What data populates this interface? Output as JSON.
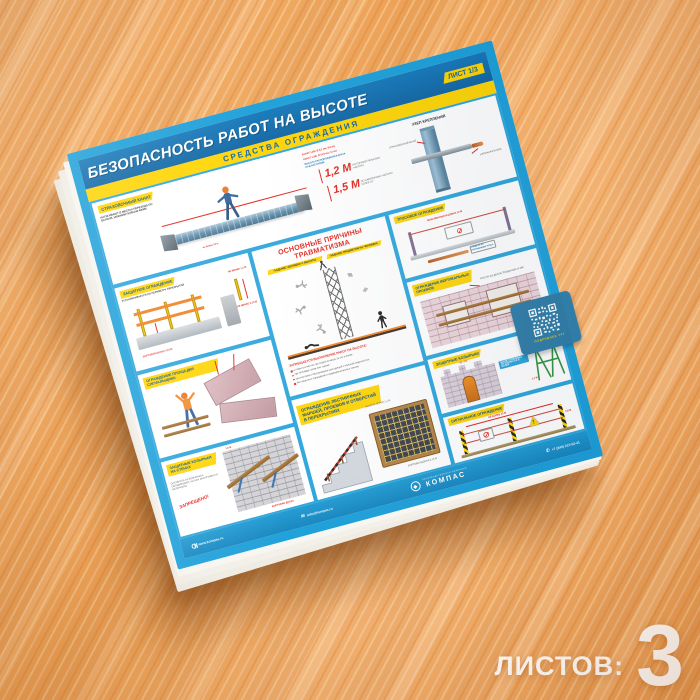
{
  "caption": {
    "sheets_label": "ЛИСТОВ:",
    "sheets_value": "3"
  },
  "colors": {
    "accent_blue": "#1b9fd9",
    "header_blue": "#0d64a3",
    "yellow": "#ffd400",
    "red": "#e2231a",
    "wood": "#f2ad66"
  },
  "poster": {
    "header": {
      "title": "БЕЗОПАСНОСТЬ РАБОТ НА ВЫСОТЕ",
      "sheet_badge": "ЛИСТ 1/3",
      "subtitle": "СРЕДСТВА ОГРАЖДЕНИЯ"
    },
    "sections": {
      "safety_rope": {
        "label": "СТРАХОВОЧНЫЙ КАНАТ",
        "note": "НАТЯГИВАЮТ В МЕСТАХ ПЕРЕХОДА ПО БАЛКАМ, НИЖНИМ ПОЯСАМ ФЕРМ",
        "dim_note": "не более 12 м",
        "spec1": "КАНАТ 1,2Б: Ø 9,1 мм; 9,6 мм",
        "spec2": "КАНАТ 1,2В: Ø 10,5 мм; 11 мм",
        "spec_caption": "ВЫСОТА РАСПОЛОЖЕНИЯ КАНАТА НАД НАСТИЛОМ",
        "h1": "1,2 М",
        "h1_caption": "ПО ГОРИЗОНТАЛЬНОМУ НАСТИЛУ",
        "h2": "1,5 М",
        "h2_caption": "ПО НАКЛОННОМУ НАСТИЛУ БОЛЕЕ 20°"
      },
      "anchor": {
        "label": "УЗЕЛ КРЕПЛЕНИЯ",
        "note1": "СТРАХОВОЧНЫЙ КАНАТ",
        "note2": "НАТЯЖНАЯ МУФТА"
      },
      "guard": {
        "label": "ЗАЩИТНОЕ ОГРАЖДЕНИЕ",
        "note": "УСТАНАВЛИВАЕТСЯ ПО ПЕРИМЕТРУ ПЕРЕКРЫТИЙ",
        "dim1": "НЕ МЕНЕЕ 1,1 М",
        "dim2": "НЕ МЕНЕЕ 0,15 М",
        "caption": "БОРТОВАЯ ДОСКА 0,15 М"
      },
      "causes": {
        "title1": "ОСНОВНЫЕ ПРИЧИНЫ",
        "title2": "ТРАВМАТИЗМА",
        "tag1": "ПАДЕНИЕ ЧЕЛОВЕКА С ВЫСОТЫ",
        "tag2": "ПАДЕНИЕ ПРЕДМЕТОВ НА ЧЕЛОВЕКА",
        "ban_title": "ЗАПРЕЩАЕТСЯ ВЫПОЛНЕНИЕ РАБОТ НА ВЫСОТЕ:",
        "ban_items": [
          "в открытых местах при скорости ветра 15 м/с и более",
          "при гололёде, грозе или тумане",
          "при монтаже и обслуживании конструкций с большой парусностью",
          "без защитных ограждений и предохранительных поясов"
        ]
      },
      "cable": {
        "label": "ТРОСОВОЕ ОГРАЖДЕНИЕ",
        "dim": "МАКСИМАЛЬНАЯ ДЛИНА 12 М",
        "note": "СЛЕДИТЬ ЗА НАТЯЖЕНИЕМ ТРОСА"
      },
      "openings": {
        "label": "ОГРАЖДЕНИЕ ВЕРТИКАЛЬНЫХ ПРОЕМОВ",
        "note": "РИГЕЛИ ИЗ ДОСОК ТОЛЩИНОЙ 40 ММ"
      },
      "platform": {
        "label": "ОГРАЖДЕНИЕ ПЛОЩАДКИ СИГНАЛЬЩИКА"
      },
      "visors": {
        "label": "ЗАЩИТНЫЕ КОЗЫРЬКИ",
        "angle": "70°–75°",
        "note": "ВЫЛЕТ КОЗЫРЬКА ОТ СТЕНЫ 2 М И БОЛЕЕ"
      },
      "trestle": {
        "dim1": "2 М",
        "dim2": "1,1 М"
      },
      "wall_visors": {
        "label": "ЗАЩИТНЫЕ КОЗЫРЬКИ НА СТЕНАХ",
        "note": "ОСТАВЛЯТЬ НА КОЗЫРЬКАХ, СКЛАДИРОВАТЬ НА НИХ ИНСТРУМЕНТ И МАТЕРИАЛЫ",
        "forbidden": "ЗАПРЕЩЕНО!",
        "dim": "1,5 М",
        "caption": "БОРТОВАЯ ДОСКА"
      },
      "stairs": {
        "label": "ОГРАЖДЕНИЕ ЛЕСТНИЧНЫХ МАРШЕЙ, ПРОЕМОВ И ОТВЕРСТИЙ В ПЕРЕКРЫТИЯХ",
        "note1": "ВЫСОТА ПЕРИЛ 1,1 М",
        "note2": "БОРТОВАЯ ДОСКА 0,15 М"
      },
      "signal": {
        "label": "СИГНАЛЬНОЕ ОГРАЖДЕНИЕ",
        "dim1": "НЕ БОЛЕЕ 12 М",
        "dim2": "0,8 М"
      }
    },
    "qr": {
      "label": "ПОДРОБНЕЕ ТУТ"
    },
    "footer": {
      "brand": "КОМПАС",
      "tagline": "ПРОИЗВОДСТВЕННАЯ КОМПАНИЯ",
      "website": "www.kompas.ru",
      "phone": "+7 (845) 215-52-41",
      "email": "info@kompas.ru"
    }
  }
}
